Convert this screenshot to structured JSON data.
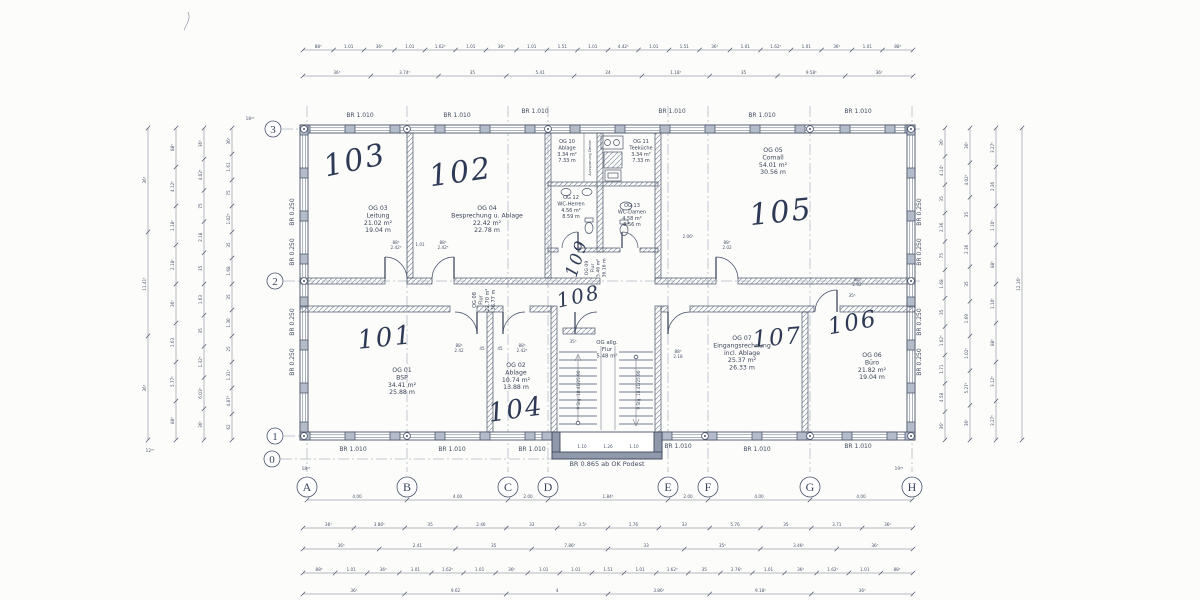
{
  "title": "Obergeschoss Grundriss Scan",
  "ink": "#404a5c",
  "paper": "#fcfcfa",
  "grid": {
    "cols": [
      "A",
      "B",
      "C",
      "D",
      "E",
      "F",
      "G",
      "H"
    ],
    "rows": [
      "3",
      "2",
      "1",
      "0"
    ]
  },
  "wall_labels": {
    "exterior": "BR 1.010",
    "side": "BR 0.250",
    "podest": "BR 0.865 ab OK Podest"
  },
  "hand": [
    "101",
    "102",
    "103",
    "104",
    "105",
    "106",
    "107",
    "108",
    "109"
  ],
  "rooms": {
    "og01": {
      "lines": [
        "OG 01",
        "BSP",
        "34.41 m²",
        "25.88 m"
      ]
    },
    "og02": {
      "lines": [
        "OG 02",
        "Ablage",
        "10.74 m²",
        "13.88 m"
      ]
    },
    "og03": {
      "lines": [
        "OG 03",
        "Leitung",
        "21.02 m²",
        "19.04 m"
      ]
    },
    "og04": {
      "lines": [
        "OG 04",
        "Besprechung u. Ablage",
        "22.42 m²",
        "22.78 m"
      ]
    },
    "og05": {
      "lines": [
        "OG 05",
        "Comall",
        "54.01 m²",
        "30.56 m"
      ]
    },
    "og06": {
      "lines": [
        "OG 06",
        "Büro",
        "21.82 m²",
        "19.04 m"
      ]
    },
    "og07": {
      "lines": [
        "OG 07",
        "Eingangsrechnung",
        "incl. Ablage",
        "25.37 m²",
        "26.33 m"
      ]
    },
    "og08": {
      "lines": [
        "OG 08",
        "Flur",
        "22.70 m²",
        "36.77 m"
      ]
    },
    "og09": {
      "lines": [
        "OG 09",
        "Flur",
        "5.46 m²",
        "36.16 m"
      ]
    },
    "og10": {
      "lines": [
        "OG 10",
        "Ablage",
        "3.34 m²",
        "7.33 m"
      ]
    },
    "og11": {
      "lines": [
        "OG 11",
        "Teeküche",
        "3.34 m²",
        "7.33 m"
      ]
    },
    "og12": {
      "lines": [
        "OG 12",
        "WC-Herren",
        "4.56 m²",
        "8.59 m"
      ]
    },
    "og13": {
      "lines": [
        "OG 13",
        "WC-Damen",
        "4.58 m²",
        "8.56 m"
      ]
    },
    "flur_allg": {
      "lines": [
        "OG allg.",
        "Flur",
        "5.48 m²"
      ]
    }
  },
  "shaft_label": "Aussparung Decke",
  "stairs": {
    "note": "9 Stg. 18.41/25.90",
    "landing_dims": [
      "1.10",
      "1.26",
      "1.10"
    ]
  },
  "inline_dims": [
    [
      "88⁵",
      "2.42⁵"
    ],
    [
      "1.01"
    ],
    [
      "88⁵",
      "2.42⁵"
    ],
    [
      "2.06⁵"
    ],
    [
      "88⁵",
      "2.02"
    ],
    [
      "88⁵",
      "2.02"
    ],
    [
      "88⁵",
      "2.42"
    ],
    [
      "45"
    ],
    [
      "45"
    ],
    [
      "88⁵",
      "2.42⁵"
    ],
    [
      "35⁵"
    ],
    [
      "88⁵",
      "2.18"
    ],
    [
      "35⁵"
    ]
  ],
  "dims": {
    "top1": [
      "88⁵",
      "1.01",
      "36⁵",
      "1.01",
      "1.62⁵",
      "1.01",
      "36⁵",
      "1.01",
      "1.51",
      "1.01",
      "4.42⁵",
      "1.01",
      "1.51",
      "36⁵",
      "1.01",
      "1.62⁵",
      "1.01",
      "36⁵",
      "1.01",
      "88⁵"
    ],
    "top2": [
      "36⁵",
      "3.74⁵",
      "35",
      "5.41",
      "24",
      "1.18⁵",
      "35",
      "9.58⁵",
      "36⁵"
    ],
    "axis_letters": [
      "4.00",
      "4.00",
      "2.00",
      "1.84⁵",
      "2.00",
      "4.00",
      "4.00"
    ],
    "bottom1": [
      "36⁵",
      "3.86⁵",
      "35",
      "2.46",
      "33",
      "3.5⁵",
      "1.76",
      "33",
      "5.76",
      "35",
      "3.71",
      "36⁵"
    ],
    "bottom2": [
      "36⁵",
      "2.41",
      "35",
      "7.86⁵",
      "33",
      "35⁵",
      "3.46⁵",
      "36⁵"
    ],
    "bottom3": [
      "88⁵",
      "1.01",
      "36⁵",
      "1.01",
      "1.62⁵",
      "1.01",
      "36⁵",
      "1.01",
      "1.01",
      "1.51",
      "1.01",
      "1.62⁵",
      "35",
      "2.76⁵",
      "1.01",
      "36⁵",
      "1.62⁵",
      "1.01",
      "88⁵"
    ],
    "bottom4": [
      "36⁵",
      "9.62",
      "4",
      "3.86⁵",
      "9.18⁵",
      "36⁵"
    ],
    "left1": [
      "36⁵",
      "11.41⁵",
      "36⁵"
    ],
    "left2": [
      "88⁵",
      "4.12⁵",
      "1.18⁵",
      "2.18⁵",
      "36⁵",
      "1.63",
      "5.77⁵",
      "88⁵"
    ],
    "left3": [
      "36⁵",
      "4.02⁵",
      "75",
      "2.18",
      "35",
      "1.63",
      "35",
      "1.32⁵",
      "6.03⁵",
      "36⁵"
    ],
    "left4": [
      "36⁵",
      "1.61",
      "75",
      "1.02⁵",
      "35",
      "1.68",
      "35",
      "1.30",
      "25",
      "1.31⁵",
      "4.87⁵",
      "62"
    ],
    "right1": [
      "36⁵",
      "4.14⁵",
      "35",
      "2.36",
      "75",
      "1.68",
      "35",
      "1.02⁵",
      "1.71",
      "4.58",
      "36⁵"
    ],
    "right2": [
      "36⁵",
      "4.02⁵",
      "35",
      "2.36",
      "35",
      "1.69",
      "1.02⁵",
      "5.27⁵",
      "36⁵"
    ],
    "right3": [
      "3.27⁵",
      "2.36",
      "1.10⁵",
      "88⁵",
      "1.10⁵",
      "88⁵",
      "3.12⁵",
      "3.27⁵"
    ],
    "right4": [
      "12.16⁵"
    ],
    "corner_marks": [
      "18²⁵",
      "12⁶⁰",
      "18²⁹",
      "19³³"
    ]
  }
}
